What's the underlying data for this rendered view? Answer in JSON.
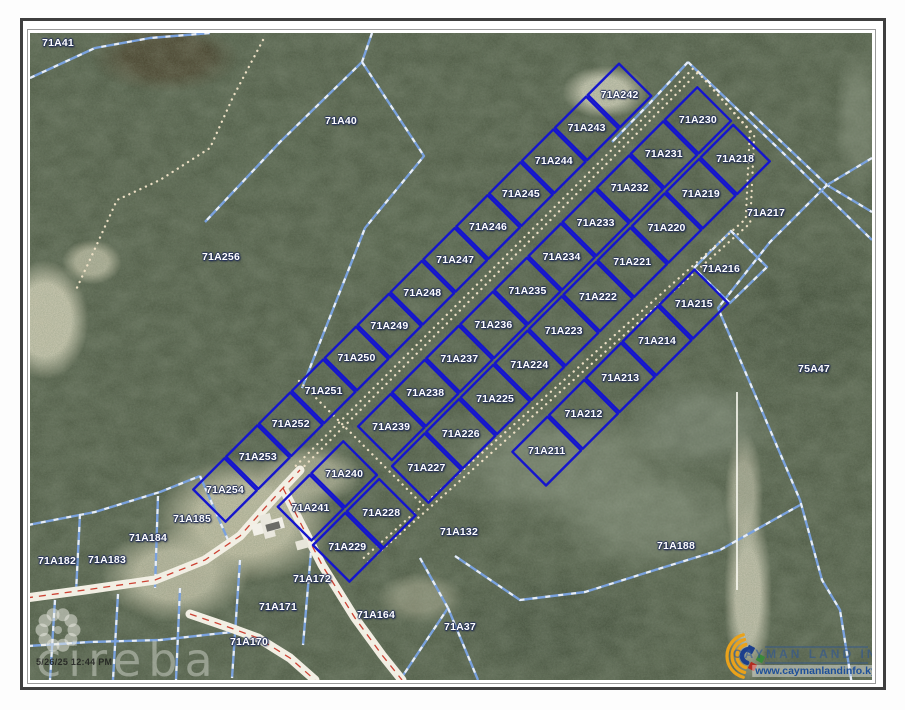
{
  "colors": {
    "parcel_light": "#7aa2de",
    "parcel_light_dash": "#f4f6fa",
    "parcel_dark": "#1515cd",
    "trail": "#ecdfc4",
    "road_fill": "#f2efe4",
    "road_center": "#cc4233",
    "label": "#ffffff",
    "white_line": "#fcfcf4",
    "logo_blue": "#1c3f8c",
    "logo_yellow": "#eaa21b",
    "logo_red": "#b32b20",
    "logo_green": "#3a8a3a"
  },
  "watermark": {
    "brand": "cireba",
    "timestamp": "5/26/25 12:44 PM"
  },
  "logo": {
    "title": "CAYMAN LAND INFO",
    "url": "www.caymanlandinfo.ky"
  },
  "map": {
    "labels": [
      {
        "text": "71A41",
        "x": 58,
        "y": 43
      },
      {
        "text": "71A40",
        "x": 341,
        "y": 121
      },
      {
        "text": "71A256",
        "x": 221,
        "y": 257
      },
      {
        "text": "71A217",
        "x": 766,
        "y": 213
      },
      {
        "text": "71A216",
        "x": 721,
        "y": 269
      },
      {
        "text": "75A47",
        "x": 814,
        "y": 369
      },
      {
        "text": "71A188",
        "x": 676,
        "y": 546
      },
      {
        "text": "71A132",
        "x": 459,
        "y": 532
      },
      {
        "text": "71A185",
        "x": 192,
        "y": 519
      },
      {
        "text": "71A184",
        "x": 148,
        "y": 538
      },
      {
        "text": "71A183",
        "x": 107,
        "y": 560
      },
      {
        "text": "71A182",
        "x": 57,
        "y": 561
      },
      {
        "text": "71A172",
        "x": 312,
        "y": 579
      },
      {
        "text": "71A171",
        "x": 278,
        "y": 607
      },
      {
        "text": "71A170",
        "x": 249,
        "y": 642
      },
      {
        "text": "71A164",
        "x": 376,
        "y": 615
      },
      {
        "text": "71A37",
        "x": 460,
        "y": 627
      }
    ],
    "subdivision": {
      "origin": {
        "x": 225,
        "y": 490
      },
      "k": 0.70711,
      "rows": [
        {
          "v": 0,
          "h": 48,
          "groups": [
            {
              "u0": 0,
              "pitch": 46.5,
              "labels": [
                "71A254",
                "71A253",
                "71A252",
                "71A251",
                "71A250",
                "71A249",
                "71A248",
                "71A247",
                "71A246",
                "71A245",
                "71A244",
                "71A243",
                "71A242"
              ]
            }
          ]
        },
        {
          "v": 73,
          "h": 50,
          "groups": [
            {
              "u0": 48,
              "pitch": 47.5,
              "labels": [
                "71A241",
                "71A240"
              ]
            },
            {
              "u0": 162,
              "pitch": 48.2,
              "labels": [
                "71A239",
                "71A238",
                "71A237",
                "71A236",
                "71A235",
                "71A234",
                "71A233",
                "71A232",
                "71A231",
                "71A230"
              ]
            }
          ]
        },
        {
          "v": 127,
          "h": 54,
          "groups": [
            {
              "u0": 46,
              "pitch": 48,
              "labels": [
                "71A229",
                "71A228"
              ]
            },
            {
              "u0": 158,
              "pitch": 48.5,
              "labels": [
                "71A227",
                "71A226",
                "71A225",
                "71A224",
                "71A223",
                "71A222",
                "71A221",
                "71A220",
                "71A219",
                "71A218"
              ]
            }
          ]
        },
        {
          "v": 200,
          "h": 50,
          "groups": [
            {
              "u0": 255,
              "pitch": 52,
              "labels": [
                "71A211",
                "71A212",
                "71A213",
                "71A214",
                "71A215"
              ]
            }
          ]
        }
      ]
    },
    "light_lines": [
      [
        [
          30,
          78
        ],
        [
          95,
          48
        ],
        [
          150,
          38
        ],
        [
          210,
          33
        ]
      ],
      [
        [
          372,
          33
        ],
        [
          362,
          62
        ],
        [
          280,
          142
        ],
        [
          205,
          222
        ]
      ],
      [
        [
          362,
          62
        ],
        [
          424,
          156
        ],
        [
          365,
          228
        ],
        [
          302,
          388
        ]
      ],
      [
        [
          688,
          62
        ],
        [
          780,
          150
        ],
        [
          872,
          240
        ]
      ],
      [
        [
          688,
          62
        ],
        [
          648,
          105
        ],
        [
          612,
          142
        ]
      ],
      [
        [
          750,
          112
        ],
        [
          827,
          185
        ],
        [
          872,
          212
        ]
      ],
      [
        [
          872,
          158
        ],
        [
          827,
          185
        ],
        [
          770,
          242
        ],
        [
          718,
          308
        ],
        [
          800,
          500
        ],
        [
          822,
          580
        ],
        [
          840,
          610
        ],
        [
          852,
          685
        ]
      ],
      [
        [
          694,
          268
        ],
        [
          731,
          231
        ],
        [
          767,
          267
        ],
        [
          730,
          303
        ],
        [
          694,
          268
        ]
      ],
      [
        [
          28,
          525
        ],
        [
          95,
          512
        ],
        [
          160,
          492
        ],
        [
          200,
          476
        ]
      ],
      [
        [
          80,
          514
        ],
        [
          76,
          592
        ]
      ],
      [
        [
          158,
          496
        ],
        [
          155,
          588
        ]
      ],
      [
        [
          200,
          476
        ],
        [
          228,
          540
        ]
      ],
      [
        [
          55,
          600
        ],
        [
          50,
          680
        ]
      ],
      [
        [
          118,
          594
        ],
        [
          113,
          680
        ]
      ],
      [
        [
          180,
          588
        ],
        [
          176,
          680
        ]
      ],
      [
        [
          240,
          560
        ],
        [
          232,
          678
        ]
      ],
      [
        [
          312,
          540
        ],
        [
          303,
          645
        ]
      ],
      [
        [
          28,
          646
        ],
        [
          90,
          642
        ],
        [
          160,
          640
        ],
        [
          232,
          632
        ]
      ],
      [
        [
          420,
          558
        ],
        [
          448,
          608
        ],
        [
          400,
          680
        ]
      ],
      [
        [
          448,
          608
        ],
        [
          478,
          680
        ]
      ],
      [
        [
          455,
          556
        ],
        [
          520,
          600
        ],
        [
          585,
          592
        ],
        [
          655,
          570
        ],
        [
          720,
          550
        ],
        [
          800,
          505
        ]
      ]
    ],
    "trails_double": [
      [
        [
          298,
          468
        ],
        [
          696,
          70
        ]
      ],
      [
        [
          366,
          560
        ],
        [
          748,
          221
        ],
        [
          752,
          133
        ],
        [
          696,
          70
        ]
      ]
    ],
    "trails_single": [
      [
        [
          263,
          40
        ],
        [
          233,
          97
        ],
        [
          210,
          148
        ],
        [
          160,
          180
        ],
        [
          117,
          200
        ],
        [
          93,
          253
        ],
        [
          75,
          292
        ]
      ],
      [
        [
          299,
          381
        ],
        [
          424,
          506
        ]
      ]
    ],
    "roads": [
      [
        [
          26,
          598
        ],
        [
          85,
          590
        ],
        [
          155,
          580
        ],
        [
          205,
          560
        ],
        [
          240,
          536
        ],
        [
          263,
          510
        ],
        [
          283,
          488
        ],
        [
          300,
          470
        ]
      ],
      [
        [
          283,
          488
        ],
        [
          300,
          522
        ],
        [
          322,
          565
        ],
        [
          355,
          618
        ],
        [
          382,
          655
        ],
        [
          402,
          680
        ]
      ],
      [
        [
          190,
          614
        ],
        [
          228,
          627
        ],
        [
          258,
          638
        ],
        [
          290,
          658
        ],
        [
          315,
          680
        ]
      ]
    ],
    "white_line": [
      [
        737,
        392
      ],
      [
        737,
        590
      ]
    ],
    "buildings": [
      {
        "x": 252,
        "y": 521,
        "w": 32,
        "h": 11,
        "fill": "#f2f0e8"
      },
      {
        "x": 262,
        "y": 514,
        "w": 11,
        "h": 24,
        "fill": "#e9e7dd"
      },
      {
        "x": 266,
        "y": 523,
        "w": 14,
        "h": 7,
        "fill": "#6b6b66"
      },
      {
        "x": 296,
        "y": 540,
        "w": 12,
        "h": 9,
        "fill": "#e8e6da"
      }
    ],
    "flower": {
      "cx": 58,
      "cy": 630,
      "ring_r": 16,
      "petal_r": 6.5,
      "petals": 10
    },
    "logo_mark": {
      "cx": 749,
      "cy": 656,
      "arc_radii": [
        12,
        17,
        22
      ],
      "rule_x1": 765,
      "rule_x2": 868,
      "rule_y1": 647,
      "rule_y2": 663
    }
  }
}
